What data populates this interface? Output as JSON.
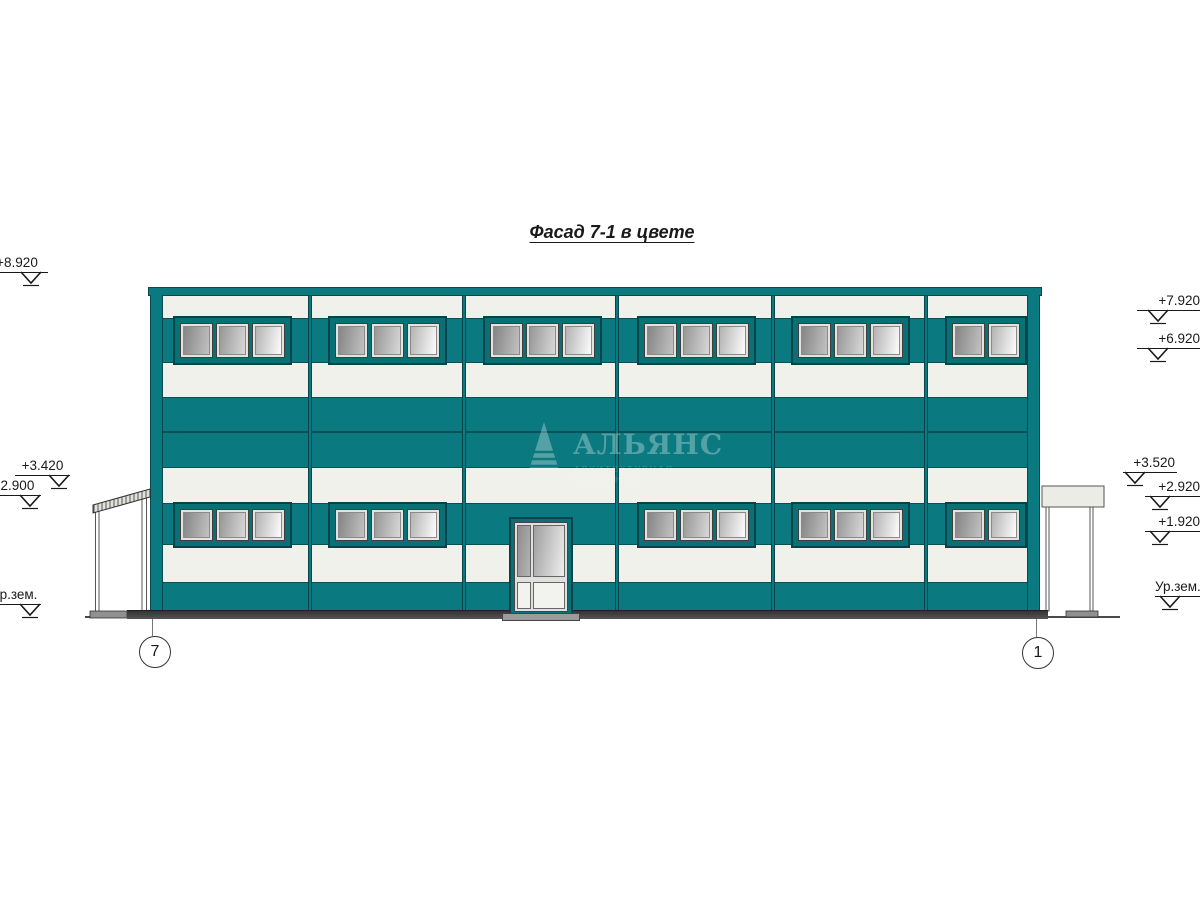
{
  "drawing": {
    "title": "Фасад 7-1 в цвете"
  },
  "watermark": {
    "name": "АЛЬЯНС",
    "subtitle": "АРХИТЕКТУРНАЯ КОМПАНИЯ"
  },
  "axis_markers": {
    "left": "7",
    "right": "1"
  },
  "elevation_marks": {
    "left": [
      {
        "label": "+8.920"
      },
      {
        "label": "+3.420"
      },
      {
        "label": "+2.900"
      },
      {
        "label": "Ур.зем."
      }
    ],
    "right": [
      {
        "label": "+7.920"
      },
      {
        "label": "+6.920"
      },
      {
        "label": "+3.520"
      },
      {
        "label": "+2.920"
      },
      {
        "label": "+1.920"
      },
      {
        "label": "Ур.зем."
      }
    ]
  },
  "colors": {
    "facade_teal": "#0b7980",
    "band_offwhite": "#f0f1ea",
    "frame_teal": "#097076",
    "outline_dark": "#064a50",
    "glass_gray": "#9f9f9f",
    "base_gray": "#3f3f3f"
  }
}
